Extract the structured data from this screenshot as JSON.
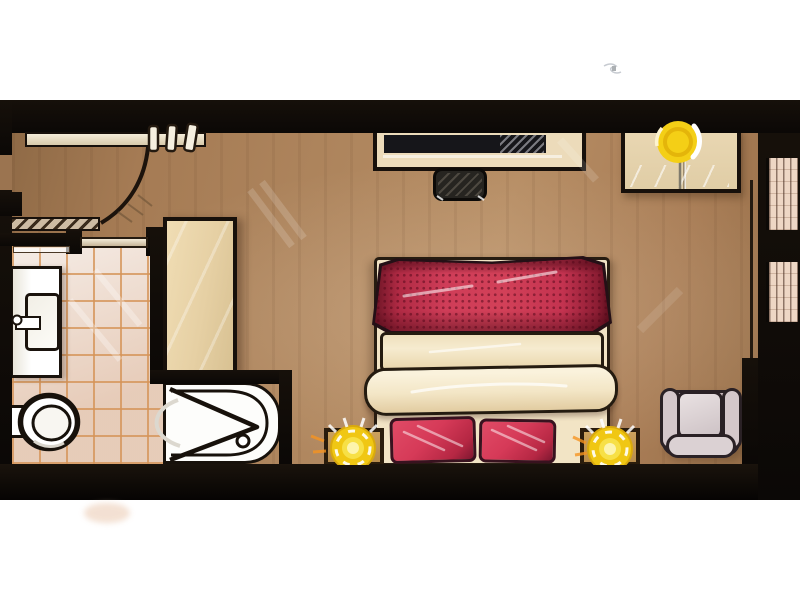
{
  "scene": {
    "title": "hand-drawn hotel room floor plan, top-down sketch",
    "background": "#ffffff",
    "canvas": {
      "width": 800,
      "height": 600
    }
  },
  "palette": {
    "wall": "#120d08",
    "wood_floor": "#a87e57",
    "tile": "#e9d5c7",
    "tile_grout": "#d5945a",
    "furniture_beige": "#e8d5ae",
    "bed_linen": "#f2e4c5",
    "bed_red": "#cf3d58",
    "pillow_red": "#d63a58",
    "lamp_yellow": "#f4cf16",
    "lamp_glow_orange": "#f59420",
    "armchair_grey": "#cfc2c5",
    "fixture_white": "#ffffff"
  },
  "rooms": [
    {
      "id": "entry",
      "label": "entry hallway"
    },
    {
      "id": "bathroom",
      "label": "bathroom with tiled floor"
    },
    {
      "id": "bedroom",
      "label": "bedroom with wood floor"
    }
  ],
  "elements": [
    {
      "name": "entry-door",
      "label": "entry door with swing arc, top-left"
    },
    {
      "name": "coat-hangers",
      "label": "rail with three hangers on top wall"
    },
    {
      "name": "bathroom-sliding-door",
      "label": "sliding door between entry and bathroom"
    },
    {
      "name": "sink-vanity",
      "label": "vanity with basin and faucet, left wall"
    },
    {
      "name": "toilet",
      "label": "toilet with tank, lower-left"
    },
    {
      "name": "bathtub",
      "label": "bathtub with folding shower screen and drain"
    },
    {
      "name": "wardrobe",
      "label": "tall wardrobe between bathroom and bedroom"
    },
    {
      "name": "desk",
      "label": "desk console against top wall"
    },
    {
      "name": "tv",
      "label": "flat TV on desk"
    },
    {
      "name": "desk-stool",
      "label": "dark stool at desk"
    },
    {
      "name": "dresser-cabinet",
      "label": "two-door cabinet with lamp, top-right"
    },
    {
      "name": "bed",
      "label": "double bed with red runner, duvet roll and two red pillows"
    },
    {
      "name": "nightstand-left",
      "label": "left nightstand with lit yellow lamp"
    },
    {
      "name": "nightstand-right",
      "label": "right nightstand with lit yellow lamp"
    },
    {
      "name": "armchair",
      "label": "grey armchair, bottom-right"
    },
    {
      "name": "wall-niches",
      "label": "two shelf niches in right wall"
    }
  ]
}
